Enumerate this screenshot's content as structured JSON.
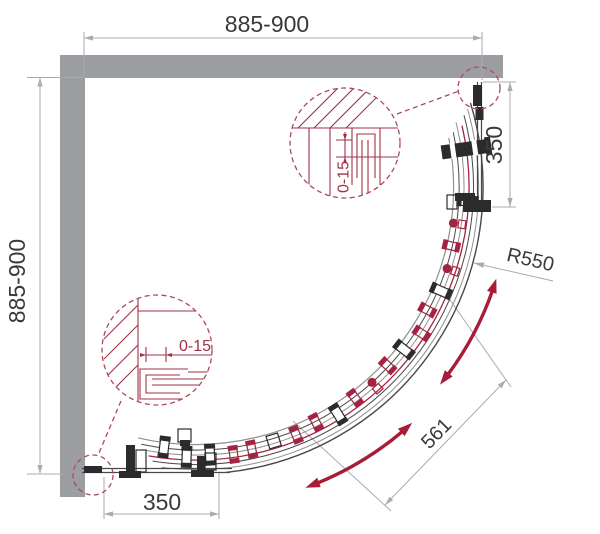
{
  "drawing": {
    "type": "shower-enclosure-plan",
    "labels": {
      "top_width": "885-900",
      "left_depth": "885-900",
      "right_fixed_panel": "350",
      "bottom_fixed_panel": "350",
      "curve_radius": "R550",
      "door_opening": "561",
      "top_wall_profile_adjustment": "0-15",
      "bottom_wall_profile_adjustment": "0-15"
    },
    "colors": {
      "wall_gray": "#9b9da0",
      "dimension_gray": "#a9abad",
      "text_dark": "#3a3a3c",
      "accent_red": "#a81c38",
      "hardware_red": "#a32440",
      "detail_red": "#a03248",
      "dash_red": "#ab4a5c",
      "line_dark": "#48484a",
      "line_mid": "#8f9092",
      "hardware_dark": "#2b2b2d"
    }
  }
}
